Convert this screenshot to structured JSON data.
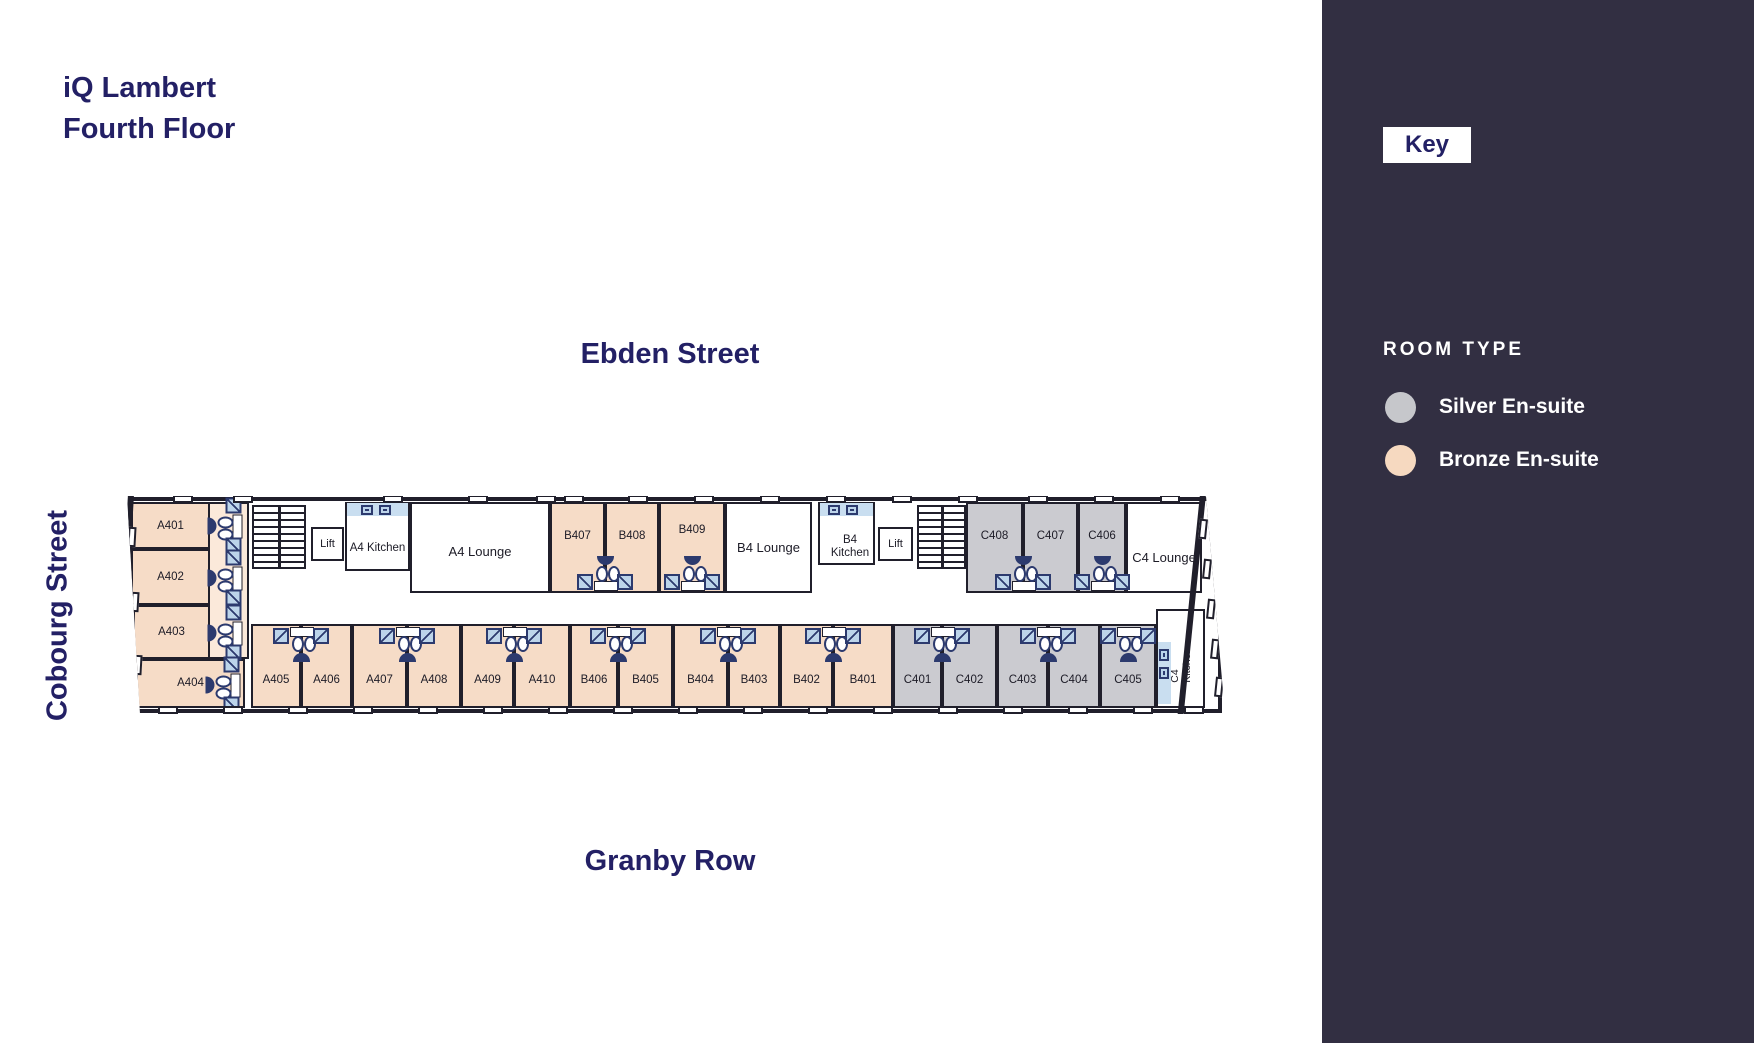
{
  "title": {
    "line1": "iQ Lambert",
    "line2": "Fourth Floor"
  },
  "streets": {
    "top": "Ebden Street",
    "bottom": "Granby Row",
    "left": "Cobourg Street"
  },
  "key": {
    "label": "Key",
    "heading": "ROOM TYPE",
    "legend": [
      {
        "label": "Silver En-suite",
        "color": "#c6c7cb"
      },
      {
        "label": "Bronze En-suite",
        "color": "#f6d9c0"
      }
    ]
  },
  "colors": {
    "bronze_room": "#f6dcc7",
    "silver_room": "#cbcbd0",
    "wall": "#201f2b",
    "sidebar_bg": "#322f42",
    "heading_navy": "#232065",
    "fixture_navy": "#2c3a6e",
    "fixture_blue": "#bcd4ea",
    "kitchen_counter_blue": "#c9def0"
  },
  "plan": {
    "rooms": {
      "a401": "A401",
      "a402": "A402",
      "a403": "A403",
      "a404": "A404",
      "a405": "A405",
      "a406": "A406",
      "a407": "A407",
      "a408": "A408",
      "a409": "A409",
      "a410": "A410",
      "b401": "B401",
      "b402": "B402",
      "b403": "B403",
      "b404": "B404",
      "b405": "B405",
      "b406": "B406",
      "b407": "B407",
      "b408": "B408",
      "b409": "B409",
      "c401": "C401",
      "c402": "C402",
      "c403": "C403",
      "c404": "C404",
      "c405": "C405",
      "c406": "C406",
      "c407": "C407",
      "c408": "C408"
    },
    "amenities": {
      "lift": "Lift",
      "a4_kitchen": "A4 Kitchen",
      "a4_lounge": "A4 Lounge",
      "b4_lounge": "B4 Lounge",
      "b4_kitchen": "B4 Kitchen",
      "c4_lounge": "C4 Lounge",
      "c4_kitchen": "C4 Kitchen"
    }
  }
}
